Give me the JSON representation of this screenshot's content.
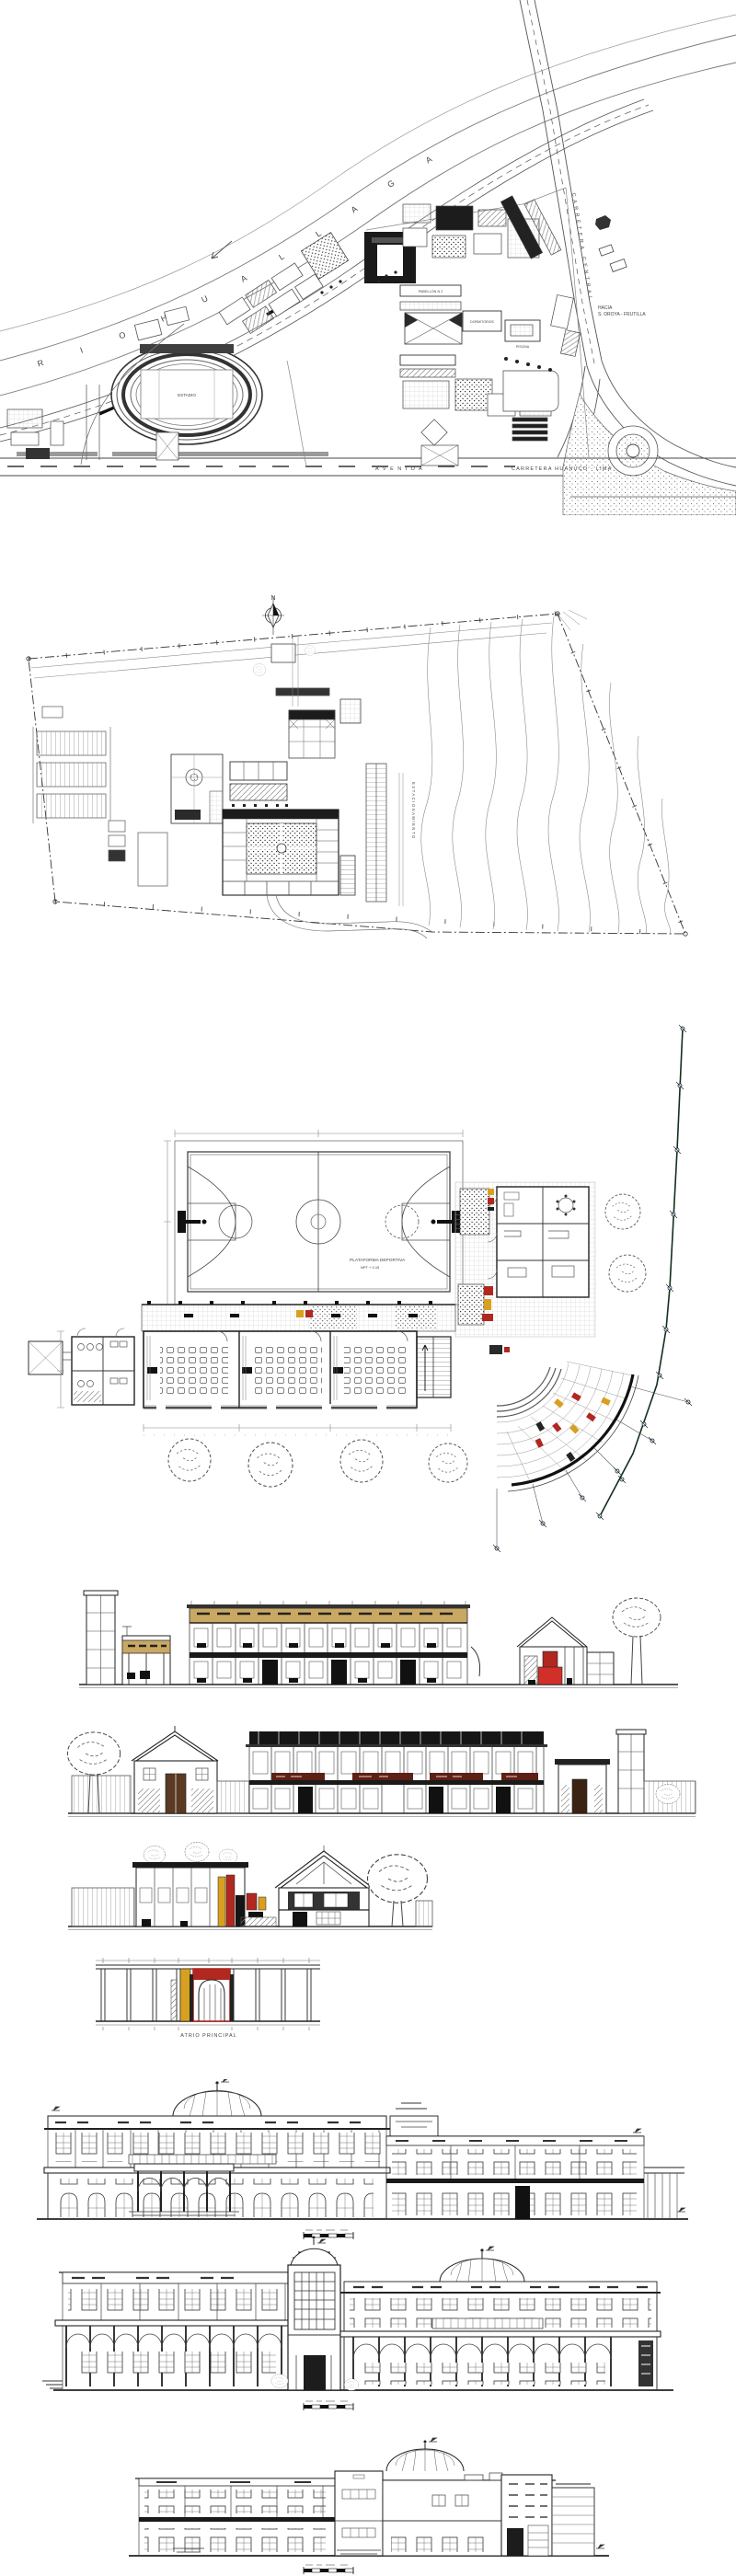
{
  "sheet": {
    "description": "Architectural CAD drawing sheet: two site plans, school floor plan, building elevations",
    "background": "#ffffff"
  },
  "colors": {
    "line": "#222222",
    "gray": "#8a8a8a",
    "tan_roof": "#c9a863",
    "red_accent": "#b02820",
    "yellow_accent": "#d8a020",
    "dark_roof": "#161616"
  },
  "site_plan_1": {
    "river_label": "R I O   H U A L L A G A",
    "highway_label": "CARRETERA CENTRAL",
    "avenue_label": "A V E N I D A",
    "road_label": "CARRETERA   HUANUCO - LIMA",
    "direction_line1": "HACIA",
    "direction_line2": "S. OROYA - FRUTILLA",
    "stadium_label": "ESTADIO",
    "pavilion_label": "PABELLON N 2",
    "dorm_label": "DORMITORIOS",
    "pool_label": "PISCINA"
  },
  "site_plan_2": {
    "north_label": "N",
    "parking_label": "ESTACIONAMIENTO"
  },
  "floor_plan": {
    "court_label": "PLATAFORMA DEPORTIVA",
    "court_sublabel": "NPT + 0.15"
  },
  "elevations": {
    "atrio_label": "ATRIO PRINCIPAL"
  }
}
